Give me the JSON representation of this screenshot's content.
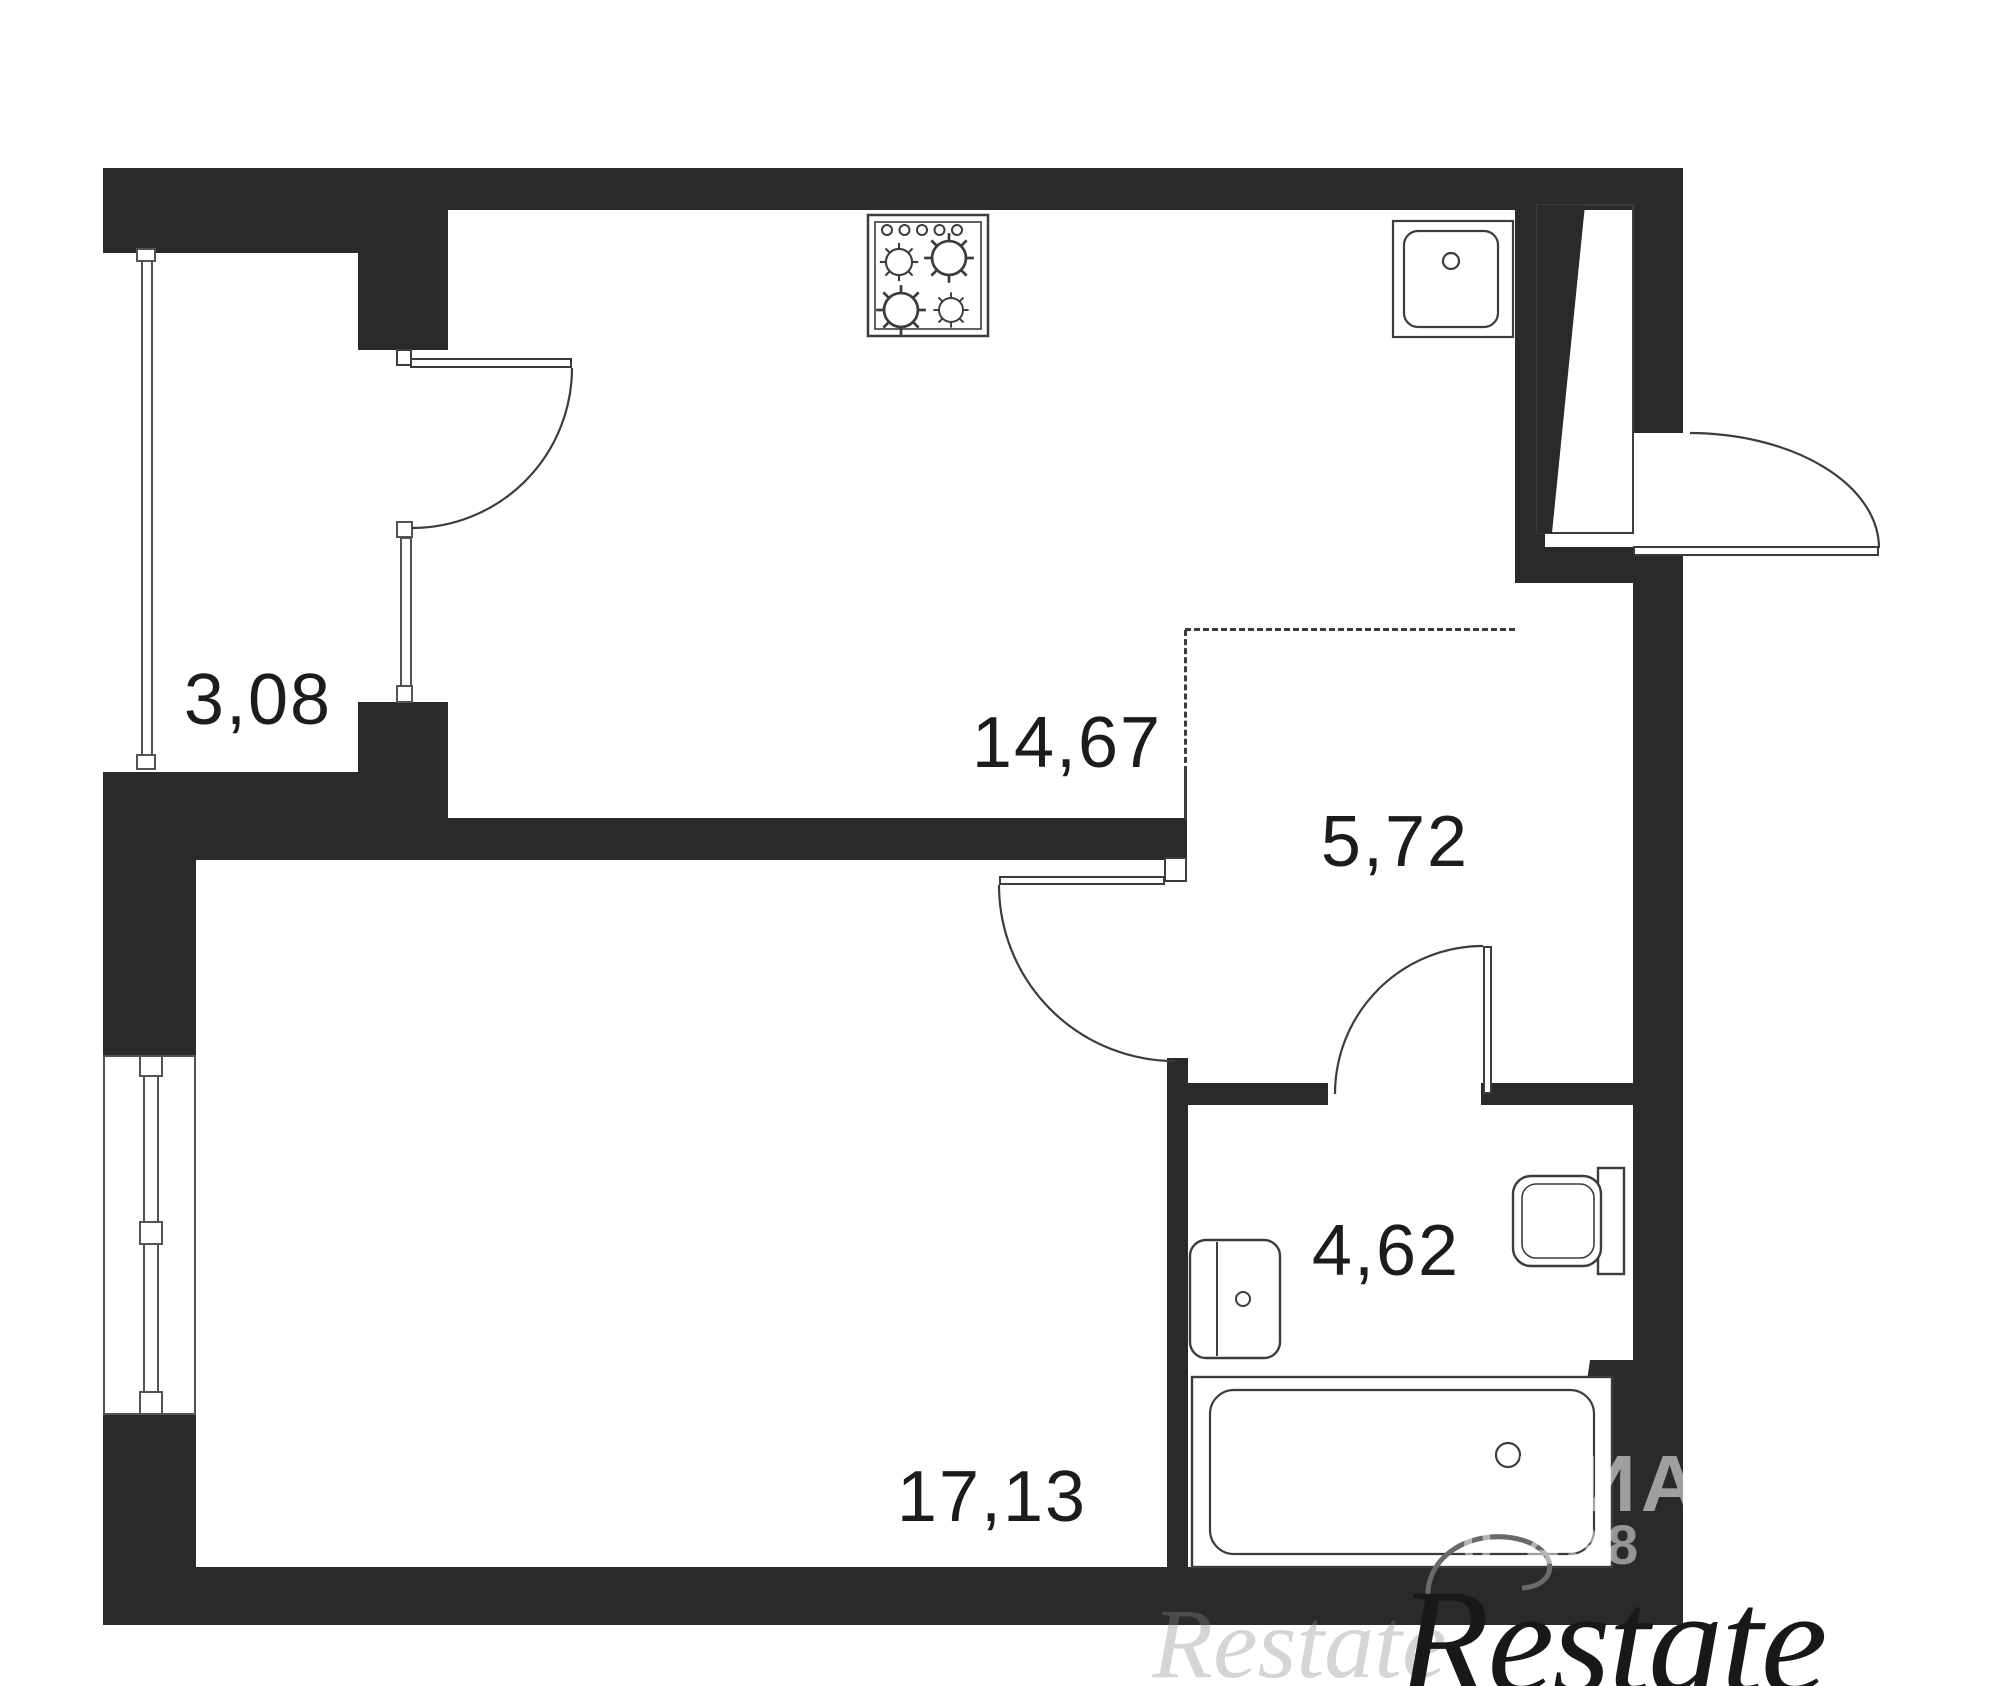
{
  "plan": {
    "background": "#ffffff",
    "wall_color": "#2b2a29",
    "line_color": "#3d3c3b",
    "label_color": "#1c1c1c",
    "rooms": [
      {
        "name": "balcony",
        "area": "3,08"
      },
      {
        "name": "kitchen-living",
        "area": "14,67"
      },
      {
        "name": "hallway",
        "area": "5,72"
      },
      {
        "name": "bathroom",
        "area": "4,62"
      },
      {
        "name": "living-room",
        "area": "17,13"
      }
    ],
    "fixtures": [
      {
        "icon": "stove-icon"
      },
      {
        "icon": "kitchen-sink-icon"
      },
      {
        "icon": "bathroom-sink-icon"
      },
      {
        "icon": "toilet-icon"
      },
      {
        "icon": "bathtub-icon"
      }
    ]
  },
  "watermarks": {
    "cian": {
      "text": "АЦИАН",
      "digits": "0 438",
      "color": "rgba(255,255,255,0.55)"
    },
    "restate": {
      "text": "Restate",
      "echo_text": "Restate",
      "color": "#181818"
    }
  }
}
